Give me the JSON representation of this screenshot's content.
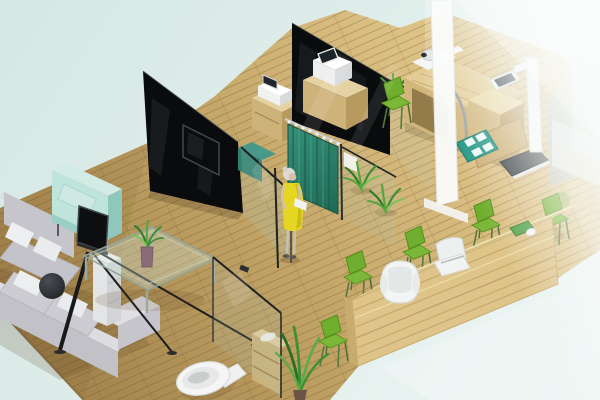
{
  "scene": {
    "type": "3d-isometric-interior-render",
    "setting": "Cutaway isometric 3D rendering of a clinic / office interior with a waiting lounge, reception counter, curtained exam bay, check-up room and toilet on a light wood floor",
    "visible_text": "none"
  },
  "colors": {
    "background_mint": "#d6e7e3",
    "background_mid": "#e0eeeb",
    "background_fade": "#eef6f4",
    "floor_wood_light": "#ddc286",
    "floor_wood_mid": "#c4a668",
    "floor_wood_dark": "#a5864f",
    "partition_black": "#0a0b0d",
    "glass_tint": "#acc9bc",
    "curtain_teal": "#2b8169",
    "curtain_fold_dark": "#1d5c4a",
    "sofa_grey": "#c6c5cb",
    "sofa_grey_light": "#dddce1",
    "pillow_white": "#edeff1",
    "armchair_mint": "#bfe4db",
    "furniture_wood": "#cdb279",
    "furniture_wood_top": "#e2cfa0",
    "counter_wood_front": "#dec489",
    "counter_wood_top": "#ecdfae",
    "chair_green": "#6fae2e",
    "chair_green_light": "#7bb838",
    "plant_green": "#3f8f34",
    "mat_teal": "#1f9583",
    "equipment_white": "#f2f3f2",
    "screen_dark": "#20262b",
    "dress_yellow": "#e5d624",
    "scale_base_dark": "#3c4043",
    "haze_white": "#f8fbfa"
  },
  "objects": [
    {
      "name": "wood-floor",
      "label": "light wood plank floor"
    },
    {
      "name": "black-partition-wall-left",
      "label": "black glass partition wall with mounted TV"
    },
    {
      "name": "black-partition-wall-middle",
      "label": "second black glass partition wall"
    },
    {
      "name": "wall-tv",
      "label": "flat TV mounted on black partition"
    },
    {
      "name": "teal-curtain",
      "label": "teal privacy curtain on rail"
    },
    {
      "name": "standing-woman",
      "label": "woman in yellow dress holding papers"
    },
    {
      "name": "glass-pane-a",
      "label": "framed glass partition panel"
    },
    {
      "name": "glass-pane-b",
      "label": "framed glass partition panel with white sign"
    },
    {
      "name": "glass-pane-c",
      "label": "framed glass panel near toilet"
    },
    {
      "name": "glass-pane-d",
      "label": "glass front of check-up room"
    },
    {
      "name": "sectional-sofa",
      "label": "grey L-shaped sectional sofa with white pillows"
    },
    {
      "name": "dark-ball-cushion",
      "label": "dark round cushion on sofa"
    },
    {
      "name": "mint-armchair",
      "label": "mint green cube armchair"
    },
    {
      "name": "tv-easel",
      "label": "TV on black A-frame easel stand"
    },
    {
      "name": "white-side-cabinet",
      "label": "white pedestal side cabinet"
    },
    {
      "name": "glass-coffee-table",
      "label": "glass coffee table"
    },
    {
      "name": "table-plant",
      "label": "plant in mauve vase on coffee table"
    },
    {
      "name": "printer-cabinet-1",
      "label": "wood cabinet with white printer and small screen"
    },
    {
      "name": "printer-cabinet-2",
      "label": "wood cabinet with white device and dark screen"
    },
    {
      "name": "teal-cabinet",
      "label": "small teal cabinet"
    },
    {
      "name": "exam-desk",
      "label": "wooden check-up desk with equipment"
    },
    {
      "name": "exam-camera-device",
      "label": "white imaging device on exam desk"
    },
    {
      "name": "exam-tablet",
      "label": "dark tablet screen on exam desk"
    },
    {
      "name": "cable-arc",
      "label": "grey arced cable/tube"
    },
    {
      "name": "teal-floor-mat",
      "label": "teal mat with four white pads"
    },
    {
      "name": "physician-scale",
      "label": "white height/weight scale with dark platform"
    },
    {
      "name": "exam-chair",
      "label": "green patient chair"
    },
    {
      "name": "floor-plants",
      "label": "green floor plants"
    },
    {
      "name": "toilet",
      "label": "white toilet"
    },
    {
      "name": "storage-shelf",
      "label": "small wooden storage shelf with towel"
    },
    {
      "name": "reception-counter",
      "label": "long curved wooden reception counter"
    },
    {
      "name": "reception-armchair",
      "label": "white rounded reception armchair"
    },
    {
      "name": "office-chair",
      "label": "white office task chair"
    },
    {
      "name": "visitor-chair",
      "label": "green visitor side chair (x5)"
    },
    {
      "name": "desk-tray",
      "label": "green tray on counter"
    },
    {
      "name": "computer-mouse",
      "label": "white computer mouse"
    },
    {
      "name": "glass-wall-haze",
      "label": "frosted foreground glass wall"
    },
    {
      "name": "glass-door-frame",
      "label": "white glass-door frame strip"
    },
    {
      "name": "mint-cabinet-behind-glass",
      "label": "mint cabinet and equipment behind frosted glass"
    }
  ]
}
